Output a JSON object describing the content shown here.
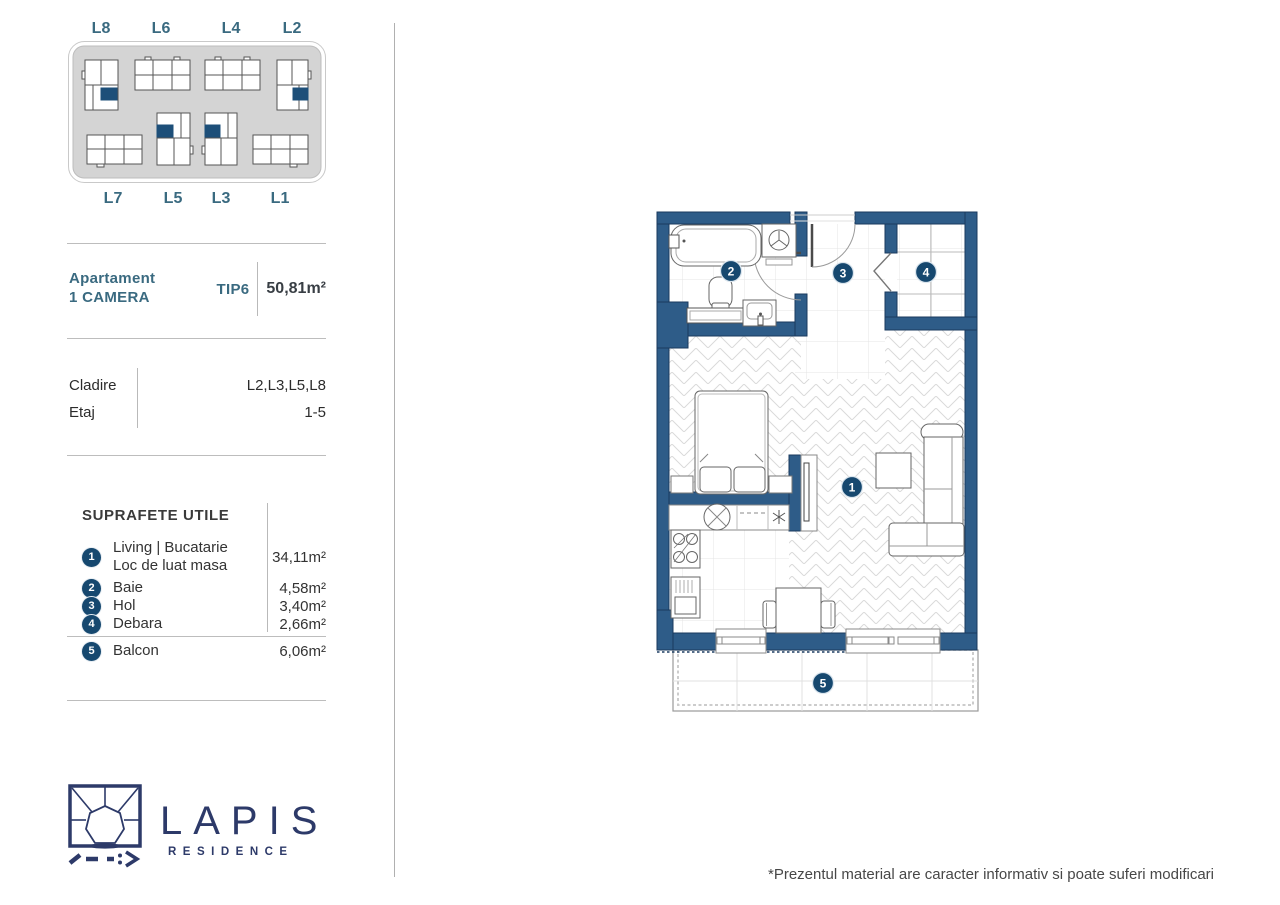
{
  "site_plan": {
    "top_labels": [
      "L8",
      "L6",
      "L4",
      "L2"
    ],
    "bottom_labels": [
      "L7",
      "L5",
      "L3",
      "L1"
    ],
    "highlighted_buildings": [
      "L8",
      "L2",
      "L5",
      "L3"
    ]
  },
  "apartment": {
    "title_line1": "Apartament",
    "title_line2": "1 CAMERA",
    "type": "TIP6",
    "area": "50,81m²",
    "cladire_label": "Cladire",
    "cladire_value": "L2,L3,L5,L8",
    "etaj_label": "Etaj",
    "etaj_value": "1-5"
  },
  "suprafete": {
    "heading": "SUPRAFETE UTILE",
    "items": [
      {
        "n": "1",
        "label": "Living | Bucatarie",
        "label2": "Loc de luat masa",
        "value": "34,11m²"
      },
      {
        "n": "2",
        "label": "Baie",
        "value": "4,58m²"
      },
      {
        "n": "3",
        "label": "Hol",
        "value": "3,40m²"
      },
      {
        "n": "4",
        "label": "Debara",
        "value": "2,66m²"
      },
      {
        "n": "5",
        "label": "Balcon",
        "value": "6,06m²"
      }
    ]
  },
  "plan": {
    "markers": [
      {
        "n": "1",
        "room": "Living | Bucatarie"
      },
      {
        "n": "2",
        "room": "Baie"
      },
      {
        "n": "3",
        "room": "Hol"
      },
      {
        "n": "4",
        "room": "Debara"
      },
      {
        "n": "5",
        "room": "Balcon"
      }
    ]
  },
  "brand": {
    "name": "LAPIS",
    "subtitle": "RESIDENCE"
  },
  "footer": {
    "disclaimer": "*Prezentul material are caracter informativ si poate suferi modificari"
  },
  "colors": {
    "wall": "#2e5c88",
    "wall_stroke": "#1a3a5e",
    "marker": "#16486f",
    "accent_teal": "#3a6a80",
    "logo_navy": "#2d3a69",
    "site_gray": "#d4d4d4",
    "highlight_unit": "#1d4f79"
  }
}
